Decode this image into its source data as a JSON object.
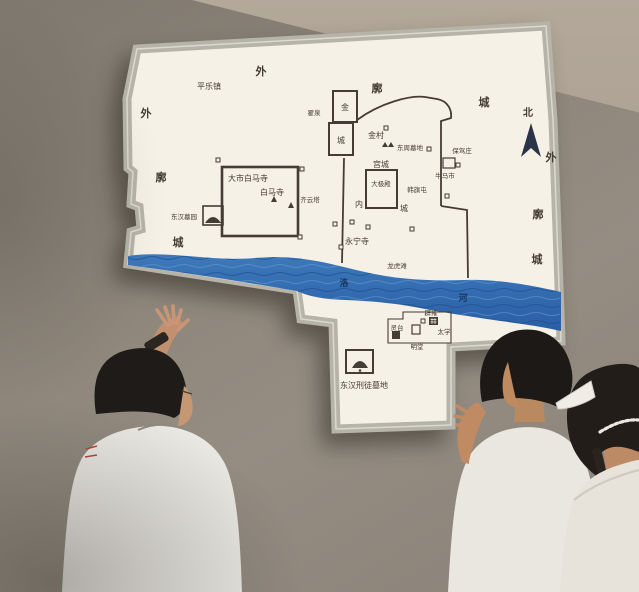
{
  "map": {
    "north_label": "北",
    "outer_wall_top": [
      "外",
      "廓",
      "城"
    ],
    "outer_wall_left": [
      "外",
      "廓",
      "城"
    ],
    "outer_wall_right": [
      "外",
      "廓",
      "城"
    ],
    "river_chars": [
      "洛",
      "河"
    ],
    "places": {
      "pingle_town": "平乐镇",
      "zhaiquan": "翟泉",
      "jinyong_top": "金",
      "jinyong_bottom": "城",
      "jincun": "金村",
      "dongzhou_cemetery": "东周墓地",
      "baojiazhuang": "保驾庄",
      "niumashi": "牛马市",
      "hanqitun": "韩旗屯",
      "palace_city": "宫城",
      "taiji_hall": "大极殿",
      "inner_city_nei": "内",
      "inner_city_cheng": "城",
      "great_market_baima": "大市白马寺",
      "baima_temple": "白马寺",
      "qiyun_pagoda": "齐云塔",
      "donghan_cemetery": "东汉墓园",
      "yongning_temple": "永宁寺",
      "longhutan": "龙虎滩",
      "lingtai": "灵台",
      "biyong": "辟雍",
      "taixue": "太学",
      "mingtang": "明堂",
      "convict_cemetery": "东汉刑徒墓地"
    }
  },
  "colors": {
    "wall": "#8d8479",
    "ceiling": "#a89d8e",
    "panel_face": "#f5f1e7",
    "panel_frame": "#b6b3a8",
    "map_line": "#443d35",
    "river_blue": "#2e6cb0",
    "compass_navy": "#2b3347"
  }
}
